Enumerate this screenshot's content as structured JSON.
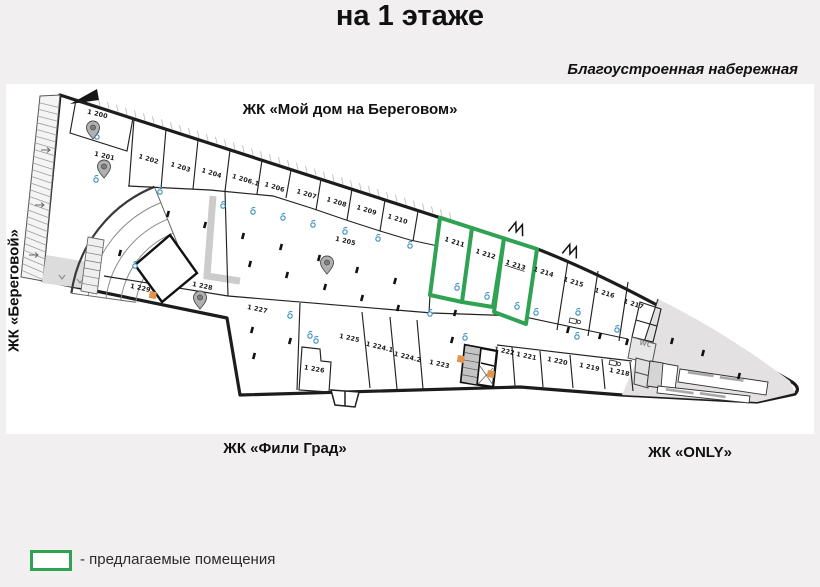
{
  "title": "на 1 этаже",
  "labels": {
    "embankment": "Благоустроенная набережная",
    "top_complex": "ЖК «Мой дом на Береговом»",
    "left_complex": "ЖК «Береговой»",
    "bottom_left_complex": "ЖК «Фили Град»",
    "bottom_right_complex": "ЖК «ONLY»"
  },
  "legend": {
    "text": "- предлагаемые помещения"
  },
  "colors": {
    "page_bg": "#f1efef",
    "plan_bg": "#ffffff",
    "wall": "#1c1c1c",
    "highlight_green": "#2fa353",
    "gray_zone": "#e3e1e1",
    "accent_orange": "#e2944d",
    "droplet_blue": "#3f93bd",
    "pin_gray": "#b0b0b0"
  },
  "icons": {
    "map_pin": "map-pin-icon",
    "water_outlet": "droplet-icon",
    "double_door": "double-door-icon",
    "workplace": "desk-icon",
    "column": "column-dot"
  },
  "highlighted_room_ids": [
    "1 211",
    "1 212",
    "1 213"
  ],
  "rooms": [
    {
      "label": "1 200",
      "x": 97,
      "y": 116,
      "r": 14
    },
    {
      "label": "1 201",
      "x": 104,
      "y": 158,
      "r": 14
    },
    {
      "label": "1 202",
      "x": 148,
      "y": 161,
      "r": 17
    },
    {
      "label": "1 203",
      "x": 180,
      "y": 169,
      "r": 17
    },
    {
      "label": "1 204",
      "x": 211,
      "y": 175,
      "r": 17
    },
    {
      "label": "1 206.1",
      "x": 245,
      "y": 182,
      "r": 17
    },
    {
      "label": "1 206",
      "x": 274,
      "y": 189,
      "r": 17
    },
    {
      "label": "1 207",
      "x": 306,
      "y": 196,
      "r": 17
    },
    {
      "label": "1 208",
      "x": 336,
      "y": 204,
      "r": 17
    },
    {
      "label": "1 209",
      "x": 366,
      "y": 212,
      "r": 17
    },
    {
      "label": "1 210",
      "x": 397,
      "y": 221,
      "r": 17
    },
    {
      "label": "1 205",
      "x": 345,
      "y": 243,
      "r": 14
    },
    {
      "label": "1 211",
      "x": 454,
      "y": 244,
      "r": 18,
      "hl": true
    },
    {
      "label": "1 212",
      "x": 485,
      "y": 256,
      "r": 18,
      "hl": true
    },
    {
      "label": "1 213",
      "x": 515,
      "y": 267,
      "r": 18,
      "hl": true,
      "underlined": true
    },
    {
      "label": "1 214",
      "x": 543,
      "y": 274,
      "r": 18
    },
    {
      "label": "1 215",
      "x": 573,
      "y": 284,
      "r": 18
    },
    {
      "label": "1 216",
      "x": 604,
      "y": 295,
      "r": 18
    },
    {
      "label": "1 217",
      "x": 633,
      "y": 306,
      "r": 18
    },
    {
      "label": "1 229",
      "x": 140,
      "y": 290,
      "r": 12
    },
    {
      "label": "1 228",
      "x": 202,
      "y": 288,
      "r": 12
    },
    {
      "label": "1 227",
      "x": 257,
      "y": 311,
      "r": 12
    },
    {
      "label": "1 226",
      "x": 314,
      "y": 371,
      "r": 10
    },
    {
      "label": "1 225",
      "x": 349,
      "y": 340,
      "r": 12
    },
    {
      "label": "1 224.1",
      "x": 379,
      "y": 349,
      "r": 14
    },
    {
      "label": "1 224.2",
      "x": 407,
      "y": 359,
      "r": 14
    },
    {
      "label": "1 223",
      "x": 439,
      "y": 366,
      "r": 12
    },
    {
      "label": "1 222",
      "x": 504,
      "y": 353,
      "r": 12
    },
    {
      "label": "1 221",
      "x": 526,
      "y": 358,
      "r": 12
    },
    {
      "label": "1 220",
      "x": 557,
      "y": 363,
      "r": 12
    },
    {
      "label": "1 219",
      "x": 589,
      "y": 369,
      "r": 12
    },
    {
      "label": "1 218",
      "x": 619,
      "y": 374,
      "r": 12
    },
    {
      "label": "WC",
      "x": 645,
      "y": 346,
      "r": 14,
      "muted": true
    }
  ]
}
